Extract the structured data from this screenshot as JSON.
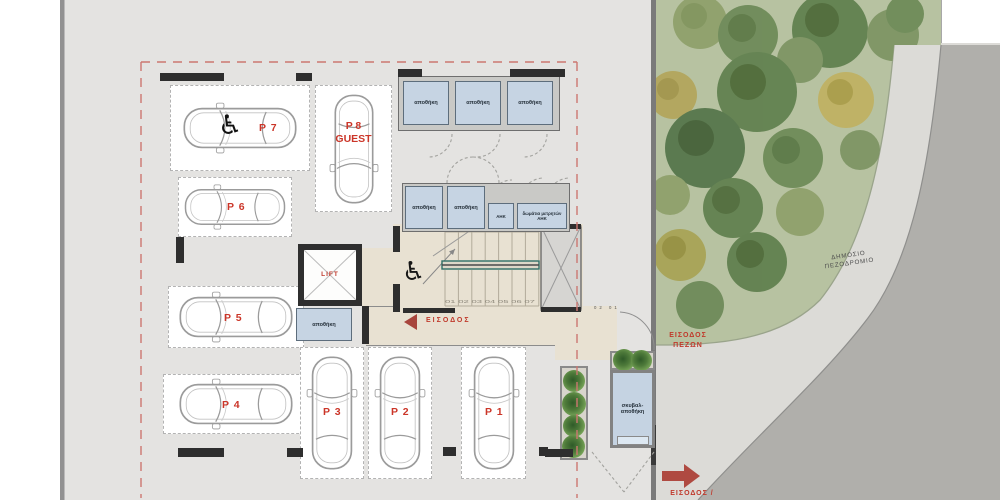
{
  "site": {
    "sidewalk_label": [
      "ΔΗΜΟΣΙΟ",
      "ΠΕΖΟΔΡΟΜΙΟ"
    ],
    "pedestrian_entrance": [
      "ΕΙΣΟΔΟΣ",
      "ΠΕΖΩΝ"
    ],
    "street_entrance": "ΕΙΣΟΔΟΣ /"
  },
  "building": {
    "main_entrance": "ΕΙΣΟΔΟΣ",
    "lift": "LIFT"
  },
  "rooms": {
    "storage_top": [
      "αποθήκη",
      "αποθήκη",
      "αποθήκη"
    ],
    "storage_mid": [
      "αποθήκη",
      "αποθήκη"
    ],
    "ahk": "ΑΗΚ",
    "meter_room": [
      "δωμάτια μετρητών",
      "ΑΗΚ"
    ],
    "lift_storage": "αποθήκη",
    "garbage_storage": [
      "σκυβαλ-",
      "αποθήκη"
    ]
  },
  "stairs": {
    "upper_steps": "16 15 14 13 12 11 10",
    "lower_steps": "01 02 03 04 05 06 07",
    "entry_steps": "02 01"
  },
  "parking": {
    "stalls": [
      {
        "label": "P 7",
        "accessible": true
      },
      {
        "label": "P 8",
        "sublabel": "GUEST"
      },
      {
        "label": "P 6"
      },
      {
        "label": "P 5"
      },
      {
        "label": "P 4"
      },
      {
        "label": "P 3"
      },
      {
        "label": "P 2"
      },
      {
        "label": "P 1"
      }
    ]
  },
  "icons": {
    "wheelchair": "♿"
  },
  "colors": {
    "accent_red": "#c0392b",
    "boundary_red": "#cc7771",
    "room_blue": "#c6d4e3",
    "floor_beige": "#e8e1d2",
    "grass_green": "#b7c2a1",
    "sidewalk_gray": "#dcdbd7",
    "road_gray": "#b0afab"
  }
}
